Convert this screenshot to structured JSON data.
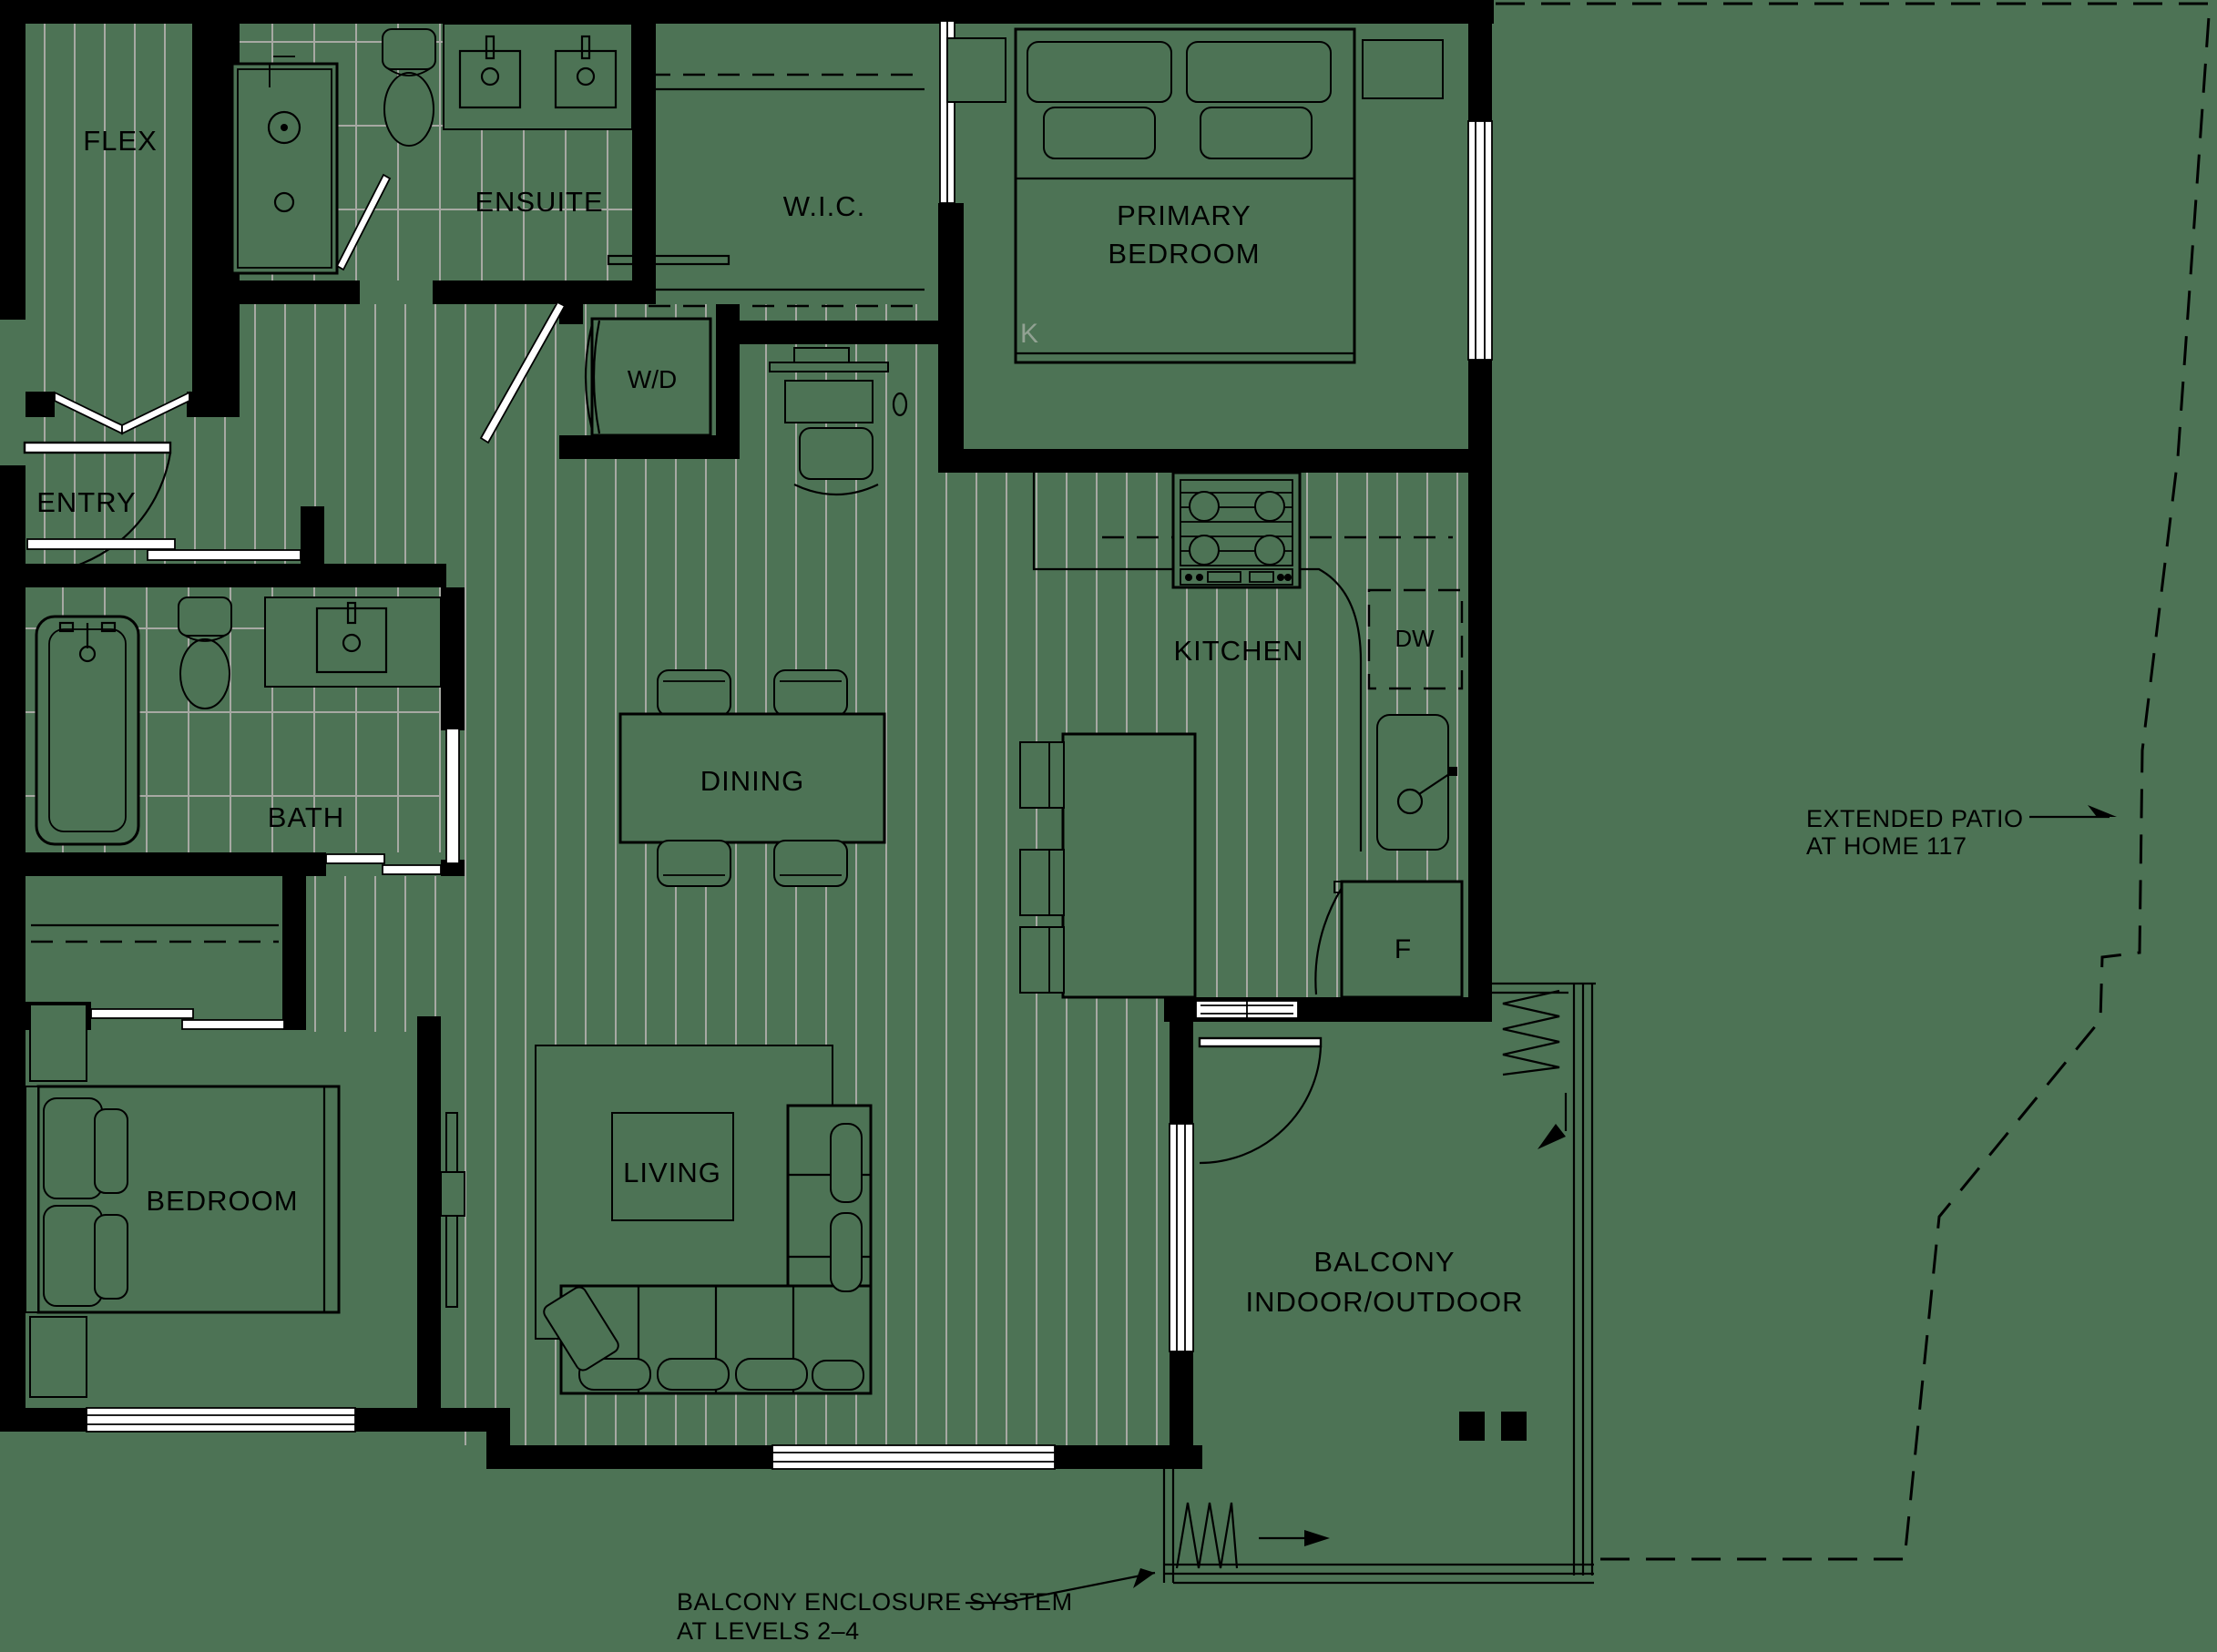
{
  "title": "Apartment floor plan",
  "colors": {
    "background": "#4d7355",
    "line": "#000000",
    "floor_hatch": "#a7a9a3",
    "window_fill": "#ffffff",
    "muted_label": "#92a293"
  },
  "rooms": {
    "flex": {
      "label": "FLEX"
    },
    "entry": {
      "label": "ENTRY"
    },
    "ensuite": {
      "label": "ENSUITE"
    },
    "wic": {
      "label": "W.I.C."
    },
    "primary_bedroom": {
      "label_line1": "PRIMARY",
      "label_line2": "BEDROOM",
      "bed_size_tag": "K"
    },
    "laundry": {
      "label": "W/D"
    },
    "kitchen": {
      "label": "KITCHEN",
      "dishwasher_tag": "DW",
      "fridge_tag": "F"
    },
    "bath": {
      "label": "BATH"
    },
    "dining": {
      "label": "DINING"
    },
    "bedroom": {
      "label": "BEDROOM"
    },
    "living": {
      "label": "LIVING"
    },
    "balcony": {
      "label_line1": "BALCONY",
      "label_line2": "INDOOR/OUTDOOR"
    }
  },
  "annotations": {
    "extended_patio": {
      "line1": "EXTENDED PATIO",
      "line2": "AT HOME 117"
    },
    "balcony_enclosure": {
      "line1": "BALCONY ENCLOSURE SYSTEM",
      "line2": "AT LEVELS 2–4"
    }
  }
}
